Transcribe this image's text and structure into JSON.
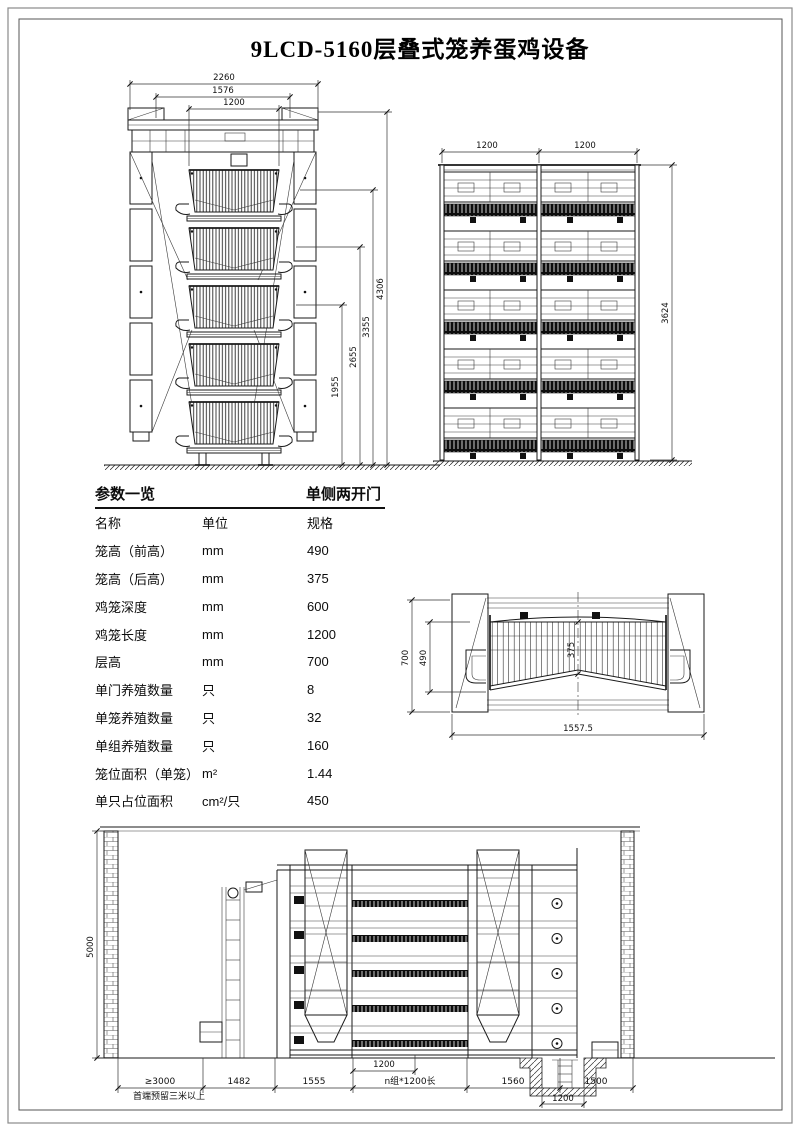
{
  "title": "9LCD-5160层叠式笼养蛋鸡设备",
  "end_view": {
    "dim_overall_width": "2260",
    "dim_frame_width": "1576",
    "dim_cage_width": "1200",
    "dim_h1": "1955",
    "dim_h2": "2655",
    "dim_h3": "3355",
    "dim_h4": "4306"
  },
  "front_view": {
    "dim_bay1": "1200",
    "dim_bay2": "1200",
    "dim_height": "3624"
  },
  "detail_view": {
    "dim_tier_height": "700",
    "dim_front_height": "490",
    "dim_rear_height": "375",
    "dim_overall_width": "1557.5"
  },
  "section_view": {
    "dim_wall_height": "5000",
    "dim_clearance": "≥3000",
    "clearance_note": "首端预留三米以上",
    "dim_1": "1482",
    "dim_2": "1555",
    "dim_group": "n组*1200长",
    "dim_3": "1560",
    "dim_4": "1500",
    "dim_cage_length": "1200",
    "dim_pit_width": "1200"
  },
  "table": {
    "title": "参数一览",
    "subtitle": "单侧两开门",
    "columns": [
      "名称",
      "单位",
      "规格"
    ],
    "rows": [
      {
        "name": "笼高（前高）",
        "unit": "mm",
        "value": "490"
      },
      {
        "name": "笼高（后高）",
        "unit": "mm",
        "value": "375"
      },
      {
        "name": "鸡笼深度",
        "unit": "mm",
        "value": "600"
      },
      {
        "name": "鸡笼长度",
        "unit": "mm",
        "value": "1200"
      },
      {
        "name": "层高",
        "unit": "mm",
        "value": "700"
      },
      {
        "name": "单门养殖数量",
        "unit": "只",
        "value": "8"
      },
      {
        "name": "单笼养殖数量",
        "unit": "只",
        "value": "32"
      },
      {
        "name": "单组养殖数量",
        "unit": "只",
        "value": "160"
      },
      {
        "name": "笼位面积（单笼）",
        "unit": "m²",
        "value": "1.44"
      },
      {
        "name": "单只占位面积",
        "unit": "cm²/只",
        "value": "450"
      }
    ]
  }
}
